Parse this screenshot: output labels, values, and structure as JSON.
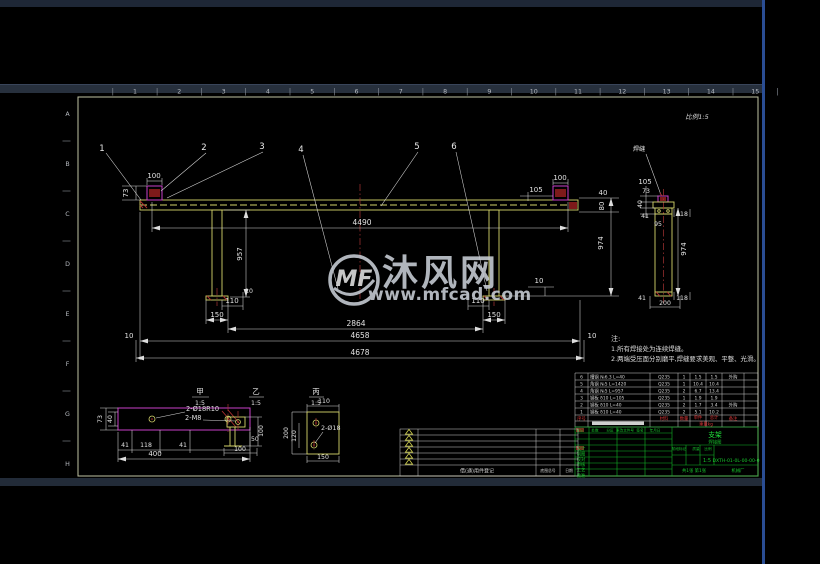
{
  "watermark": {
    "logo": "MF",
    "brand": "沐风网",
    "url": "www.mfcad.com"
  },
  "frame": {
    "zones_top": [
      "1",
      "2",
      "3",
      "4",
      "5",
      "6",
      "7",
      "8",
      "9",
      "10",
      "11",
      "12",
      "13",
      "14",
      "15"
    ],
    "zones_left": [
      "A",
      "B",
      "C",
      "D",
      "E",
      "F",
      "G",
      "H"
    ]
  },
  "balloons": {
    "b1": "1",
    "b2": "2",
    "b3": "3",
    "b4": "4",
    "b5": "5",
    "b6": "6"
  },
  "front": {
    "d73": "73",
    "d100l": "100",
    "d4490": "4490",
    "d957": "957",
    "d105": "105",
    "d100r": "100",
    "d40": "40",
    "d80": "80",
    "d974": "974",
    "d110l": "110",
    "d10a": "10",
    "d150l": "150",
    "d110r": "110",
    "d150r": "150",
    "d10b": "10",
    "d2864": "2864",
    "d4658": "4658",
    "d4678": "4678",
    "d10c": "10",
    "d10d": "10"
  },
  "section": {
    "view_label": "比例1:5",
    "weld": "焊缝",
    "d105": "105",
    "d73": "73",
    "d40": "40",
    "d41t": "41",
    "d118t": "118",
    "d95": "95",
    "d974": "974",
    "d41b": "41",
    "d118b": "118",
    "d200": "200"
  },
  "notes": {
    "title": "注:",
    "l1": "1.所有焊接处为连续焊缝。",
    "l2": "2.两端受压面分别磨平,焊缝要求美观、平整、光滑。"
  },
  "details": {
    "jia": {
      "name": "甲",
      "scale": "1:5",
      "holes": "2-Ø18R10",
      "tap": "2-M8",
      "d73": "73",
      "d40": "40",
      "d41l": "41",
      "d118": "118",
      "d41r": "41",
      "d400": "400"
    },
    "yi": {
      "name": "乙",
      "scale": "1:5",
      "d100v": "100",
      "d50": "50",
      "d100h": "100"
    },
    "bing": {
      "name": "丙",
      "scale": "1:5",
      "holes": "2-Ø18",
      "d110": "110",
      "d200": "200",
      "d120": "120",
      "d150": "150"
    }
  },
  "bom": {
    "headers": {
      "no": "序号",
      "name": "名  称",
      "mat": "材料",
      "qty": "数量",
      "unit": "单件",
      "total": "总计",
      "weight": "重量kg",
      "rem": "备注"
    },
    "rows": [
      {
        "no": "6",
        "name": "槽钢 №6.3 L=40",
        "mat": "Q235",
        "qty": "1",
        "unit": "1.5",
        "total": "1.5",
        "rem": "外购"
      },
      {
        "no": "5",
        "name": "角钢 №5 L=1420",
        "mat": "Q235",
        "qty": "1",
        "unit": "10.4",
        "total": "10.4",
        "rem": ""
      },
      {
        "no": "4",
        "name": "角钢 №5 L=957",
        "mat": "Q235",
        "qty": "2",
        "unit": "6.7",
        "total": "13.4",
        "rem": ""
      },
      {
        "no": "3",
        "name": "钢板 δ10 L=105",
        "mat": "Q235",
        "qty": "1",
        "unit": "1.9",
        "total": "1.9",
        "rem": ""
      },
      {
        "no": "2",
        "name": "钢板 δ10 L=40",
        "mat": "Q235",
        "qty": "2",
        "unit": "1.7",
        "total": "3.4",
        "rem": "外购"
      },
      {
        "no": "1",
        "name": "钢板 δ10 L=40",
        "mat": "Q235",
        "qty": "2",
        "unit": "5.1",
        "total": "10.2",
        "rem": ""
      }
    ]
  },
  "titleblock": {
    "rows_left": [
      "设计",
      "制图",
      "校对",
      "审核",
      "工艺",
      "批准"
    ],
    "cols_mid": [
      "标记",
      "处数",
      "分区",
      "更改文件号",
      "签名",
      "年月日"
    ],
    "stage": "阶段标记",
    "mass": "质量",
    "scale_label": "比例",
    "scale": "1:5",
    "name_l1": "支架",
    "name_l2": "焊接图",
    "drawing_no": "DXTH-01-0L-00-00-0",
    "sheets": "共1张 第1张",
    "company": "机械厂"
  },
  "borrow": {
    "caption": "借(通)用件登记",
    "h1": "底图总号",
    "h2": "日期"
  }
}
